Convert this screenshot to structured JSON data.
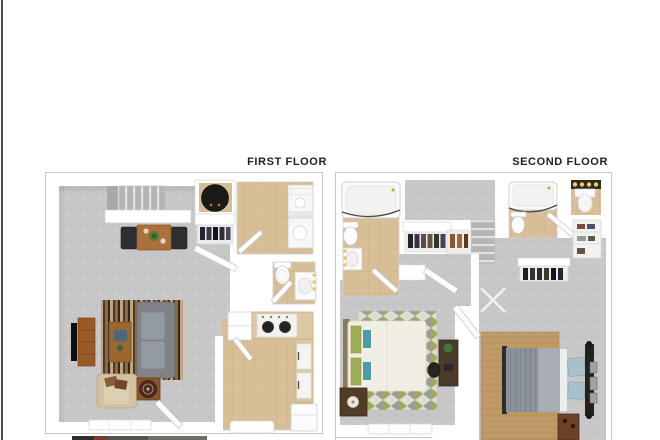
{
  "image": {
    "kind": "3d-floorplan-rendering",
    "background": "#ffffff"
  },
  "plans": [
    {
      "label": "FIRST FLOOR",
      "rooms": [
        "living-dining-room",
        "kitchen",
        "half-bathroom",
        "laundry-room",
        "coat-closet",
        "water-heater-closet",
        "staircase"
      ]
    },
    {
      "label": "SECOND FLOOR",
      "rooms": [
        "bedroom-1",
        "bedroom-2",
        "bathroom-1",
        "bathroom-2",
        "vanity-nook",
        "linen-closet",
        "hallway",
        "staircase"
      ]
    }
  ],
  "palette": {
    "carpet": "#c7c7c7",
    "tile": "#d8bf97",
    "wall": "#ffffff",
    "frame_border": "#c9c9c9",
    "label_text": "#1f1f1f",
    "wood": "#9a6a38",
    "sofa_gray": "#8a8c90",
    "rug_olive": "#a4a85c",
    "rug_tan": "#c09a66",
    "pillow_blue": "#a9bfcb",
    "pillow_green": "#9fae54",
    "vanity_light": "#eac45f",
    "left_edge_line": "#4d4d4d"
  }
}
